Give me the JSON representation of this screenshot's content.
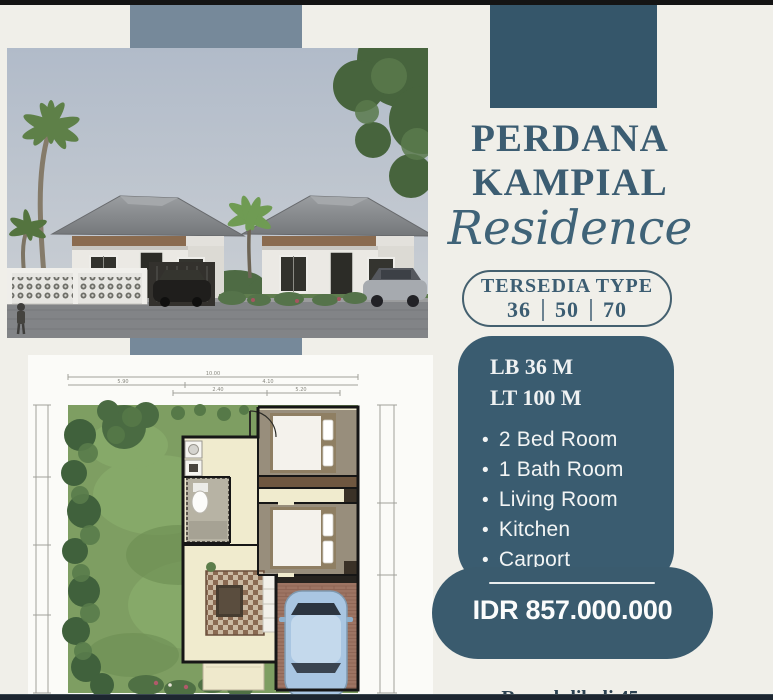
{
  "colors": {
    "background": "#f0efe9",
    "accent_teal": "#3a5c70",
    "ribbon_blue": "#76899a",
    "title_text": "#3c5d72"
  },
  "title": {
    "line1": "PERDANA",
    "line2": "KAMPIAL",
    "script": "Residence"
  },
  "availability": {
    "label": "TERSEDIA TYPE",
    "types": [
      "36",
      "50",
      "70"
    ]
  },
  "specs": {
    "building_area": "LB 36 M",
    "land_area": "LT 100 M"
  },
  "features": [
    "2 Bed Room",
    "1 Bath Room",
    "Living Room",
    "Kitchen",
    "Carport"
  ],
  "price": "IDR 857.000.000",
  "footer": {
    "brand": "Rumahdibali 45"
  },
  "floor_plan": {
    "dims": [
      "10.00",
      "5.90",
      "4.10",
      "2.40",
      "5.20"
    ]
  }
}
